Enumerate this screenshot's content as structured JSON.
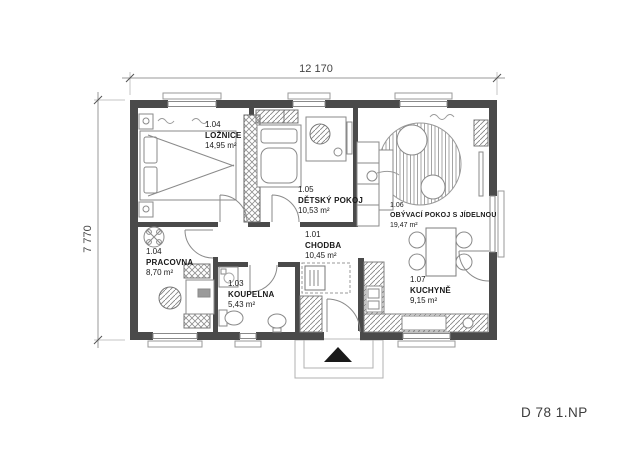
{
  "title": "D 78 1.NP",
  "dimensions": {
    "width_label": "12 170",
    "height_label": "7 770"
  },
  "rooms": [
    {
      "number": "1.04",
      "name": "LOŽNICE",
      "area": "14,95 m²"
    },
    {
      "number": "1.05",
      "name": "DĚTSKÝ POKOJ",
      "area": "10,53 m²"
    },
    {
      "number": "1.06",
      "name": "OBÝVACÍ POKOJ S JÍDELNOU",
      "area": "19,47 m²"
    },
    {
      "number": "1.01",
      "name": "CHODBA",
      "area": "10,45 m²"
    },
    {
      "number": "1.04",
      "name": "PRACOVNA",
      "area": "8,70 m²"
    },
    {
      "number": "1.03",
      "name": "KOUPELNA",
      "area": "5,43 m²"
    },
    {
      "number": "1.07",
      "name": "KUCHYNĚ",
      "area": "9,15 m²"
    }
  ],
  "colors": {
    "wall": "#4a4a4a",
    "furniture_line": "#8a8a8a",
    "text": "#1a1a1a",
    "entrance_marker": "#1a1a1a"
  },
  "icons": {
    "entrance_marker": "entrance-arrow-icon",
    "ceiling_fan": "ceiling-fan-icon"
  }
}
